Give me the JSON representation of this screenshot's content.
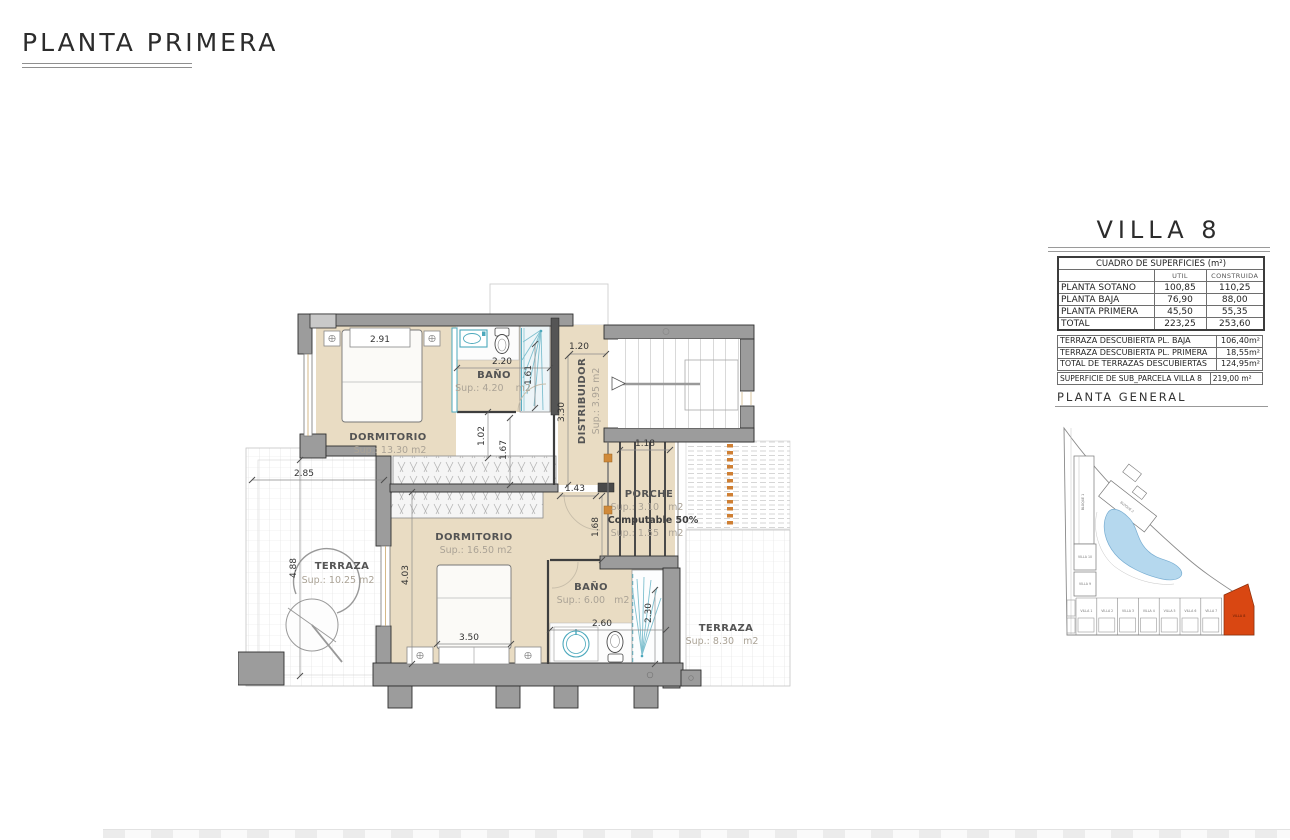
{
  "title": "PLANTA PRIMERA",
  "colors": {
    "floor_beige": "#e9dcc3",
    "wall_gray": "#9c9c9c",
    "fixture_teal": "#4ba8bc",
    "highlight_orange": "#d94712",
    "lagoon_blue": "#b5d8ee"
  },
  "plan": {
    "rooms": {
      "dorm1": {
        "name": "DORMITORIO",
        "sup": "Sup.: 13.30  m2"
      },
      "bano1": {
        "name": "BAÑO",
        "sup": "Sup.: 4.20    m2"
      },
      "distrib": {
        "name": "DISTRIBUIDOR",
        "sup": "Sup.: 3.95  m2"
      },
      "dorm2": {
        "name": "DORMITORIO",
        "sup": "Sup.: 16.50  m2"
      },
      "bano2": {
        "name": "BAÑO",
        "sup": "Sup.: 6.00   m2"
      },
      "porche": {
        "name": "PORCHE",
        "sup1": "Sup.: 3.10   m2",
        "computable": "Computable 50%",
        "sup2": "Sup.: 1.55   m2"
      },
      "terraza1": {
        "name": "TERRAZA",
        "sup": "Sup.: 10.25  m2"
      },
      "terraza2": {
        "name": "TERRAZA",
        "sup": "Sup.: 8.30   m2"
      }
    },
    "dims": {
      "d291": "2.91",
      "d220": "2.20",
      "d161": "1.61",
      "d120": "1.20",
      "d330": "3.30",
      "d102": "1.02",
      "d167": "1.67",
      "d143": "1.43",
      "d118": "1.18",
      "d168": "1.68",
      "d285": "2.85",
      "d488": "4.88",
      "d403": "4.03",
      "d350": "3.50",
      "d260": "2.60",
      "d230": "2.30"
    }
  },
  "panel": {
    "villa_title": "VILLA 8",
    "surfaces_table": {
      "title": "CUADRO DE SUPERFICIES (m²)",
      "col_util": "UTIL",
      "col_construida": "CONSTRUIDA",
      "rows": [
        {
          "label": "PLANTA SOTANO",
          "util": "100,85",
          "construida": "110,25"
        },
        {
          "label": "PLANTA BAJA",
          "util": "76,90",
          "construida": "88,00"
        },
        {
          "label": "PLANTA PRIMERA",
          "util": "45,50",
          "construida": "55,35"
        },
        {
          "label": "TOTAL",
          "util": "223,25",
          "construida": "253,60"
        }
      ]
    },
    "terrace_table": {
      "rows": [
        {
          "label": "TERRAZA DESCUBIERTA PL. BAJA",
          "value": "106,40m²"
        },
        {
          "label": "TERRAZA DESCUBIERTA PL. PRIMERA",
          "value": "18,55m²"
        },
        {
          "label": "TOTAL DE TERRAZAS DESCUBIERTAS",
          "value": "124,95m²"
        }
      ]
    },
    "parcel_row": {
      "label": "SUPERFICIE DE SUB_PARCELA VILLA 8",
      "value": "219,00 m²"
    },
    "site_title": "PLANTA GENERAL"
  },
  "site": {
    "bloque1": "BLOQUE 1",
    "bloque2": "BLOQUE 2",
    "left_villas": [
      "VILLA 10",
      "VILLA 9"
    ],
    "villas": [
      "VILLA 1",
      "VILLA 2",
      "VILLA 3",
      "VILLA 4",
      "VILLA 5",
      "VILLA 6",
      "VILLA 7"
    ],
    "highlight": "VILLA 8"
  }
}
